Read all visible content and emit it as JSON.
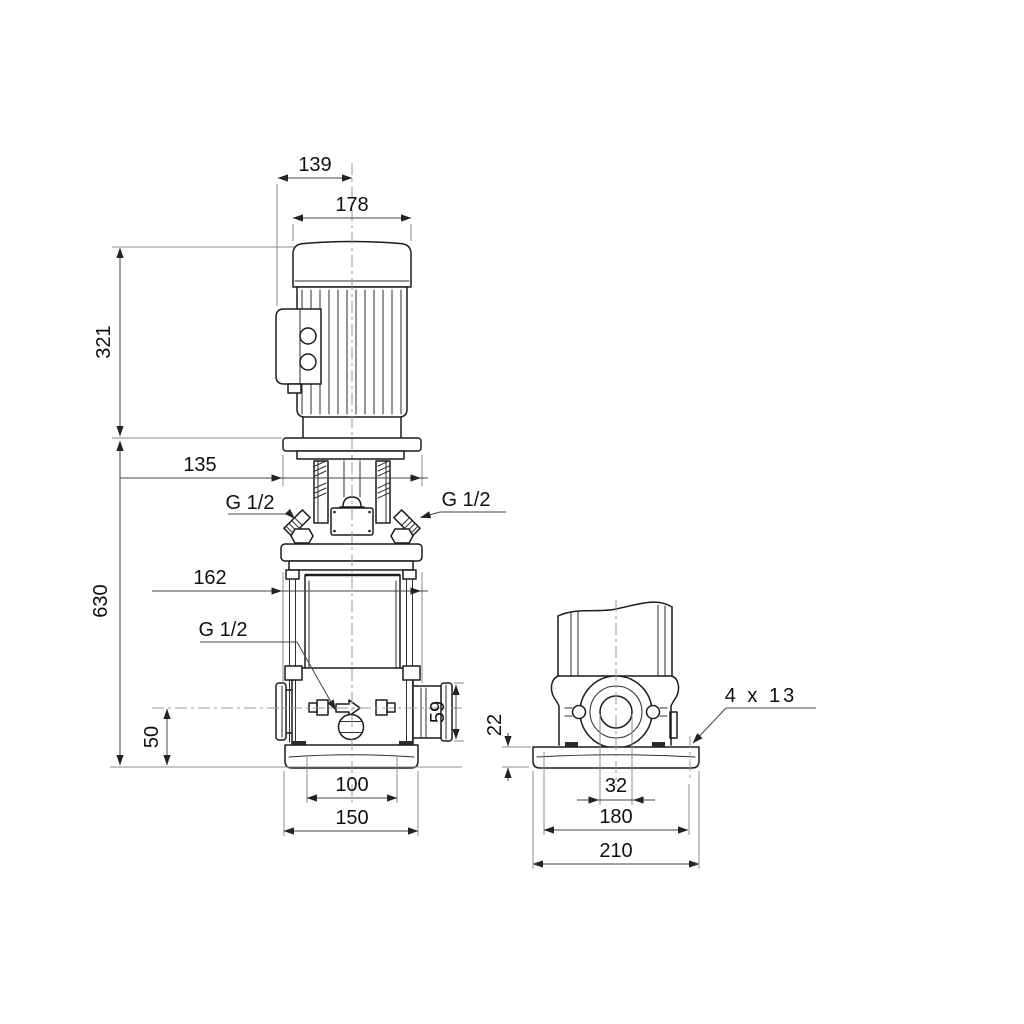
{
  "drawing": {
    "front_view": {
      "dims": {
        "top_width": "139",
        "motor_width": "178",
        "motor_height": "321",
        "flange_width": "135",
        "total_height": "630",
        "head_width": "162",
        "port_center_height": "50",
        "port_flange_height": "59",
        "base_bolt_span": "100",
        "base_width": "150"
      },
      "threads": {
        "vent_left": "G 1/2",
        "vent_right": "G 1/2",
        "drain": "G 1/2"
      }
    },
    "side_view": {
      "dims": {
        "baseplate_thickness": "22",
        "port_bore": "32",
        "base_bolt_span": "180",
        "base_width": "210"
      },
      "notes": {
        "bolt_holes": "4 x 13"
      }
    },
    "colors": {
      "outline": "#1c1c1c",
      "dimension": "#454545",
      "extension": "#8c8c8c",
      "centerline": "#9a9a9a",
      "background": "#ffffff",
      "text": "#101010"
    }
  }
}
